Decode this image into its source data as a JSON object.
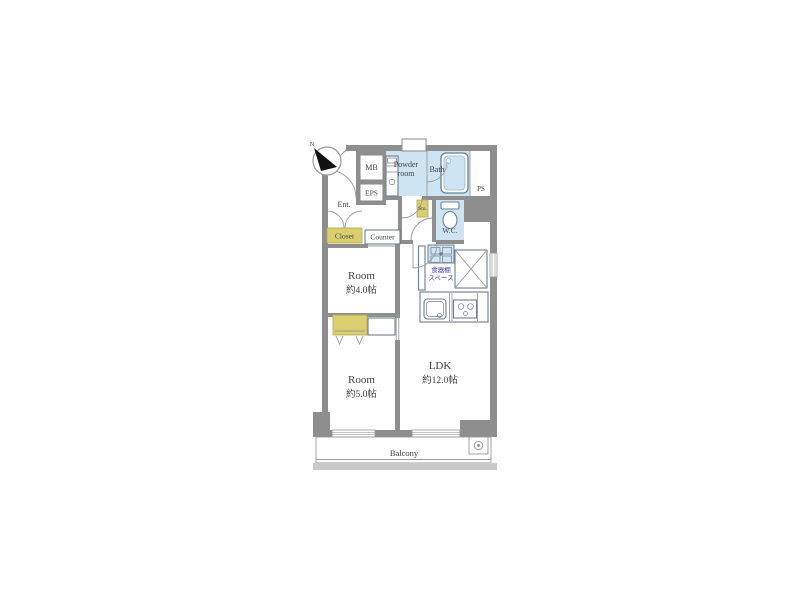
{
  "floorplan": {
    "labels": {
      "compass_north": "N",
      "mb": "MB",
      "eps": "EPS",
      "ent": "Ent.",
      "closet": "Closet",
      "counter": "Counter",
      "powder_line1": "Powder",
      "powder_line2": "room",
      "bath": "Bath",
      "ps": "PS",
      "sto": "Sto.",
      "wc": "W.C.",
      "dish_shelf_line1": "食器棚",
      "dish_shelf_line2": "スペース",
      "room_north_name": "Room",
      "room_north_size": "約4.0帖",
      "room_south_name": "Room",
      "room_south_size": "約5.0帖",
      "ldk_name": "LDK",
      "ldk_size": "約12.0帖",
      "balcony": "Balcony"
    },
    "colors": {
      "wall": "#8e8e8e",
      "wall_light": "#c9c9c9",
      "water": "#cfe4f2",
      "storage": "#d9cf6e",
      "storage_border": "#b2a751",
      "text": "#404040",
      "accent_text": "#3c3cb4",
      "fixture": "#6d7f90"
    }
  }
}
